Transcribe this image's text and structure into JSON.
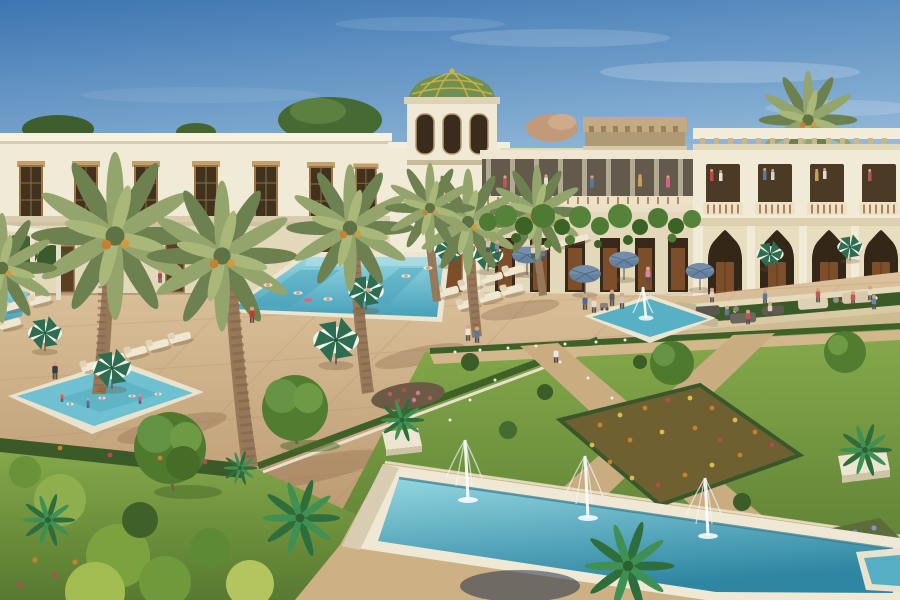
{
  "meta": {
    "type": "3d-architectural-rendering",
    "subject": "Moorish-Mediterranean resort courtyard with swimming pools, formal gardens, fountains and date palms",
    "width_px": 900,
    "height_px": 600
  },
  "scene": {
    "elements": [
      {
        "name": "sky",
        "label": "Clear gradient blue sky with faint clouds"
      },
      {
        "name": "left-wing-building",
        "label": "Two-storey cream building with lattice windows"
      },
      {
        "name": "dome-tower",
        "label": "Square tower with green and gold tiled dome"
      },
      {
        "name": "roof-crown",
        "label": "Carved tan cornice crown over central gallery"
      },
      {
        "name": "upper-gallery",
        "label": "Open first-floor gallery with slim posts and visitors"
      },
      {
        "name": "vine-canopy",
        "label": "Green vines draped over ground-floor arcade"
      },
      {
        "name": "right-arcade-facade",
        "label": "Moorish pointed-arch arcade with balustraded balconies"
      },
      {
        "name": "terrace-steps",
        "label": "Stepped terraces with hedges and outdoor sofas"
      },
      {
        "name": "plaza-paving",
        "label": "Tan stone plaza and pool deck"
      },
      {
        "name": "main-pool",
        "label": "Large rectangular swimming pool with bathers"
      },
      {
        "name": "kids-pool",
        "label": "Children's pool lower left"
      },
      {
        "name": "courtyard-fountain",
        "label": "Square plaza fountain with single jet"
      },
      {
        "name": "long-fountain-pool",
        "label": "Long raised fountain basin with three jets"
      },
      {
        "name": "corner-pool",
        "label": "Pool sliver in lower-right corner"
      },
      {
        "name": "left-garden",
        "label": "Lawn with round clipped trees and bright shrubs"
      },
      {
        "name": "formal-gardens",
        "label": "Parterre beds crossed by diagonal paths"
      },
      {
        "name": "orange-flower-bed",
        "label": "Marigold parterre bed"
      },
      {
        "name": "lavender-flower-bed",
        "label": "Purple flower bed lower right"
      },
      {
        "name": "date-palms",
        "label": "Olive-green date palms with orange fruit"
      },
      {
        "name": "fan-palms",
        "label": "Bright green fan palms"
      },
      {
        "name": "green-striped-umbrellas",
        "label": "Green and white striped parasols"
      },
      {
        "name": "blue-umbrellas",
        "label": "Slate-blue cafe parasols"
      },
      {
        "name": "sun-loungers",
        "label": "Cream sun loungers"
      },
      {
        "name": "people",
        "label": "Small figures strolling, sitting, swimming"
      }
    ]
  },
  "colors": {
    "sky_top": "#3d76b2",
    "sky_mid": "#8ab2d4",
    "sky_horizon": "#d8e8f1",
    "cream": "#f1ead6",
    "cream_shade": "#e4d8bb",
    "cornice": "#c2ab83",
    "stone_gray": "#b3aa94",
    "dome_green": "#6e9050",
    "dome_gold": "#d3b244",
    "glass_dark": "#41321e",
    "wood": "#7c4e2a",
    "paving_light": "#dbc29c",
    "paving_dark": "#b18d63",
    "water_light": "#93d6e0",
    "water_deep": "#47a0ba",
    "fountain_deep": "#2e86a2",
    "grass_light": "#86aa4b",
    "grass_dark": "#587a31",
    "hedge": "#3a5a27",
    "frond_dark": "#6d8150",
    "frond_light": "#93a46d",
    "frond_hi": "#a9b878",
    "trunk": "#97795a",
    "fan_dark": "#2e6e3c",
    "fan_light": "#3f9052",
    "umb_green": "#2e6d51",
    "umb_white": "#f2f5ea",
    "umb_blue": "#66829f",
    "fl_orange": "#c5812f",
    "fl_yellow": "#d8bc4e",
    "fl_red": "#b04c52",
    "fl_white": "#eef0e3",
    "fl_purple": "#8c90c8",
    "skin": "#d9a47e",
    "shadow_brown": "#6b4f33"
  }
}
